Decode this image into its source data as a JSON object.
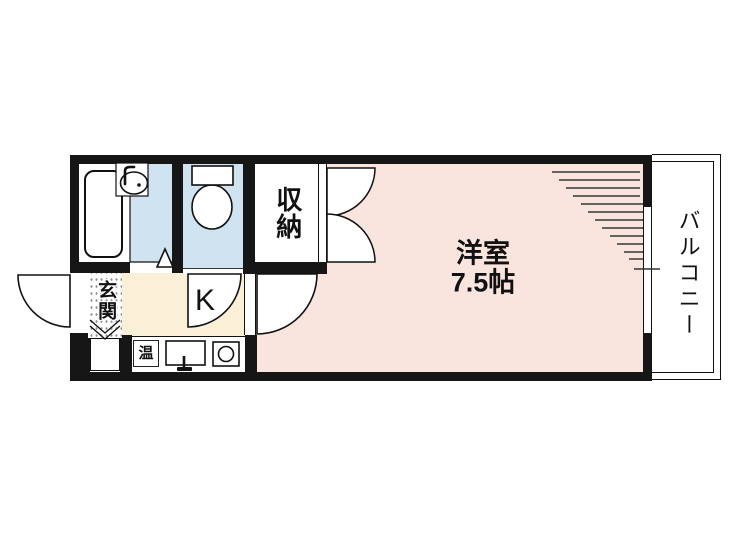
{
  "floorplan": {
    "labels": {
      "western_room_name": "洋室",
      "western_room_size": "7.5帖",
      "balcony": "バルコニー",
      "storage": "収納",
      "kitchen": "K",
      "entrance": "玄関",
      "water_heater": "温"
    },
    "colors": {
      "wall": "#161616",
      "western_room": "#FAE5DE",
      "kitchen": "#FAF0D8",
      "wet_area": "#CFE3F1",
      "white": "#FFFFFF"
    }
  }
}
